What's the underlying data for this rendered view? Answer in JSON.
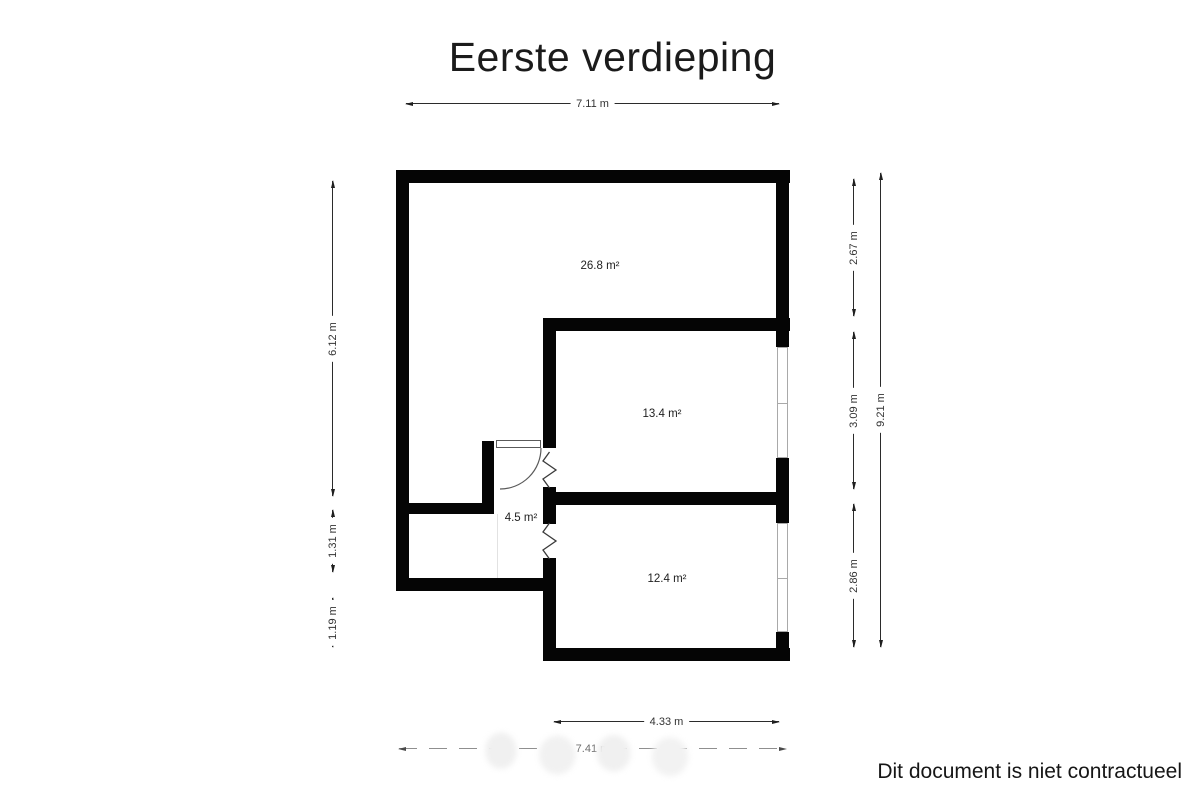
{
  "title": "Eerste verdieping",
  "footer": {
    "disclaimer": "Dit document is niet contractueel"
  },
  "floorplan": {
    "rooms": [
      {
        "name": "large-room",
        "area_label": "26.8 m²"
      },
      {
        "name": "middle-room",
        "area_label": "13.4 m²"
      },
      {
        "name": "hallway",
        "area_label": "4.5 m²"
      },
      {
        "name": "bottom-room",
        "area_label": "12.4 m²"
      }
    ],
    "dimensions": {
      "top_width": "7.11 m",
      "left": [
        "6.12 m",
        "1.31 m",
        "1.19 m"
      ],
      "right_inner": [
        "2.67 m",
        "3.09 m",
        "2.86 m"
      ],
      "right_total_height": "9.21 m",
      "bottom_inner_width": "4.33 m",
      "bottom_total_width": "7.41 m"
    },
    "colors": {
      "wall": "#050505",
      "dimension_line": "#2b2b2b",
      "window_frame": "#a9a9a9",
      "faded_dimension": "#8f8f8f"
    }
  }
}
